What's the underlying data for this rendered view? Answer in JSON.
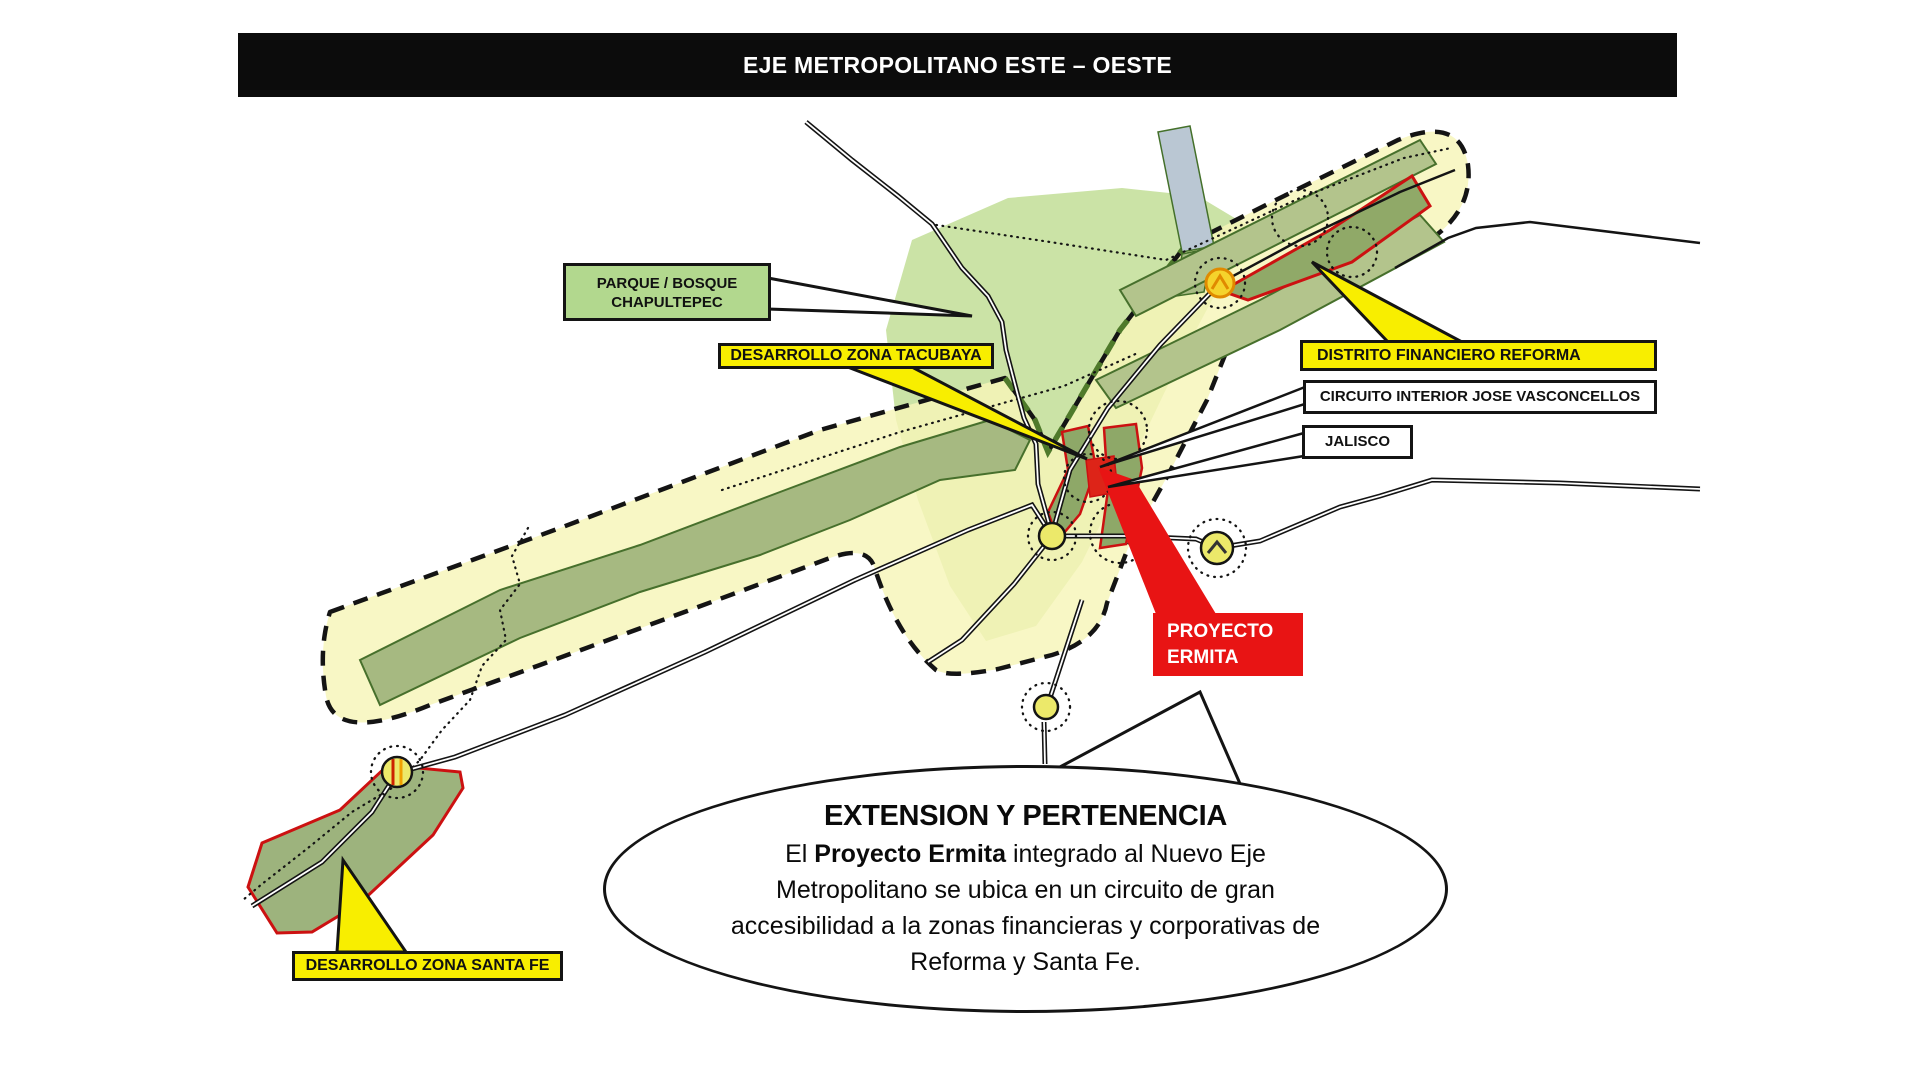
{
  "slide": {
    "title": "EJE METROPOLITANO ESTE – OESTE"
  },
  "labels": {
    "chapultepec": {
      "line1": "PARQUE / BOSQUE",
      "line2": "CHAPULTEPEC"
    },
    "tacubaya": {
      "text": "DESARROLLO ZONA TACUBAYA"
    },
    "reforma": {
      "text": "DISTRITO FINANCIERO  REFORMA"
    },
    "circuito": {
      "text": "CIRCUITO INTERIOR JOSE VASCONCELLOS"
    },
    "jalisco": {
      "text": "JALISCO"
    },
    "ermita": {
      "line1": "PROYECTO",
      "line2": "ERMITA"
    },
    "santa_fe": {
      "text": "DESARROLLO ZONA SANTA FE"
    }
  },
  "bubble": {
    "title": "EXTENSION Y PERTENENCIA",
    "body_prefix": "El ",
    "body_bold": "Proyecto Ermita",
    "body_rest": " integrado al Nuevo Eje Metropolitano se ubica en un circuito de gran accesibilidad a la zonas financieras y corporativas de Reforma y Santa Fe."
  },
  "colors": {
    "title_bar_bg": "#0c0c0c",
    "label_yellow": "#f8ee00",
    "label_green": "#b2d88e",
    "label_red": "#e81414",
    "corridor_yellow": "#f6f4bc",
    "park_green": "#cbe3a6",
    "strip_olive": "#a6b981",
    "zone_outline_red": "#cc1111",
    "node_yellow": "#ece96a",
    "road_black": "#141414",
    "rail_blue_gray": "#bac7d3"
  }
}
